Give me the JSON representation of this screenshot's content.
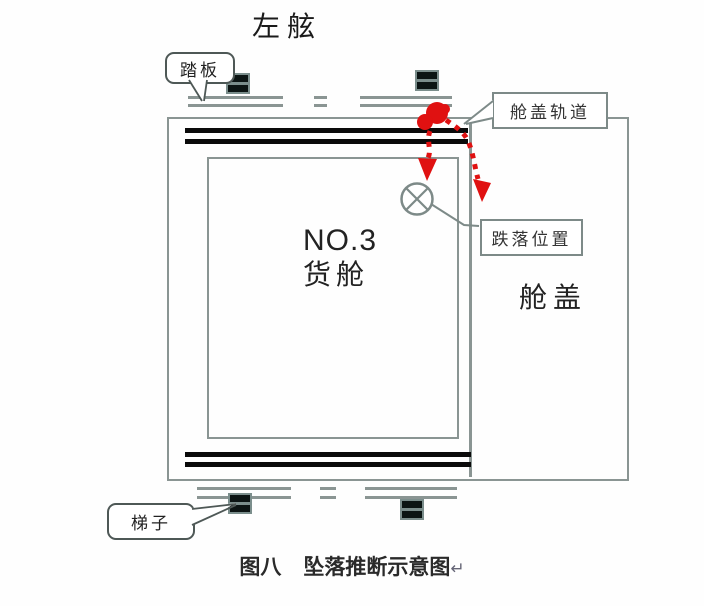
{
  "figure": {
    "title": "左舷",
    "hold_label_line1": "NO.3",
    "hold_label_line2": "货舱",
    "hatch_cover_label": "舱盖",
    "callouts": {
      "pedal": "踏板",
      "hatch_rail": "舱盖轨道",
      "fall_position": "跌落位置",
      "ladder": "梯子"
    },
    "caption": {
      "figure_number": "图八",
      "caption_text": "坠落推断示意图",
      "paragraph_mark": "↵"
    },
    "icons": {
      "fall_origin": "red-dot-icon",
      "impact_point": "circle-x-icon",
      "fall_trajectories": "red-dotted-arrow-icons",
      "cleats": "double-bar-cleat-icons"
    },
    "colors": {
      "diagram_line": "#8a9593",
      "label_box_border": "#7d8a88",
      "callout_border": "#4e5856",
      "rail_black": "#0a0a0a",
      "cleat_teal": "#7b8e8c",
      "fall_path_red": "#e01111",
      "text": "#222222"
    }
  }
}
